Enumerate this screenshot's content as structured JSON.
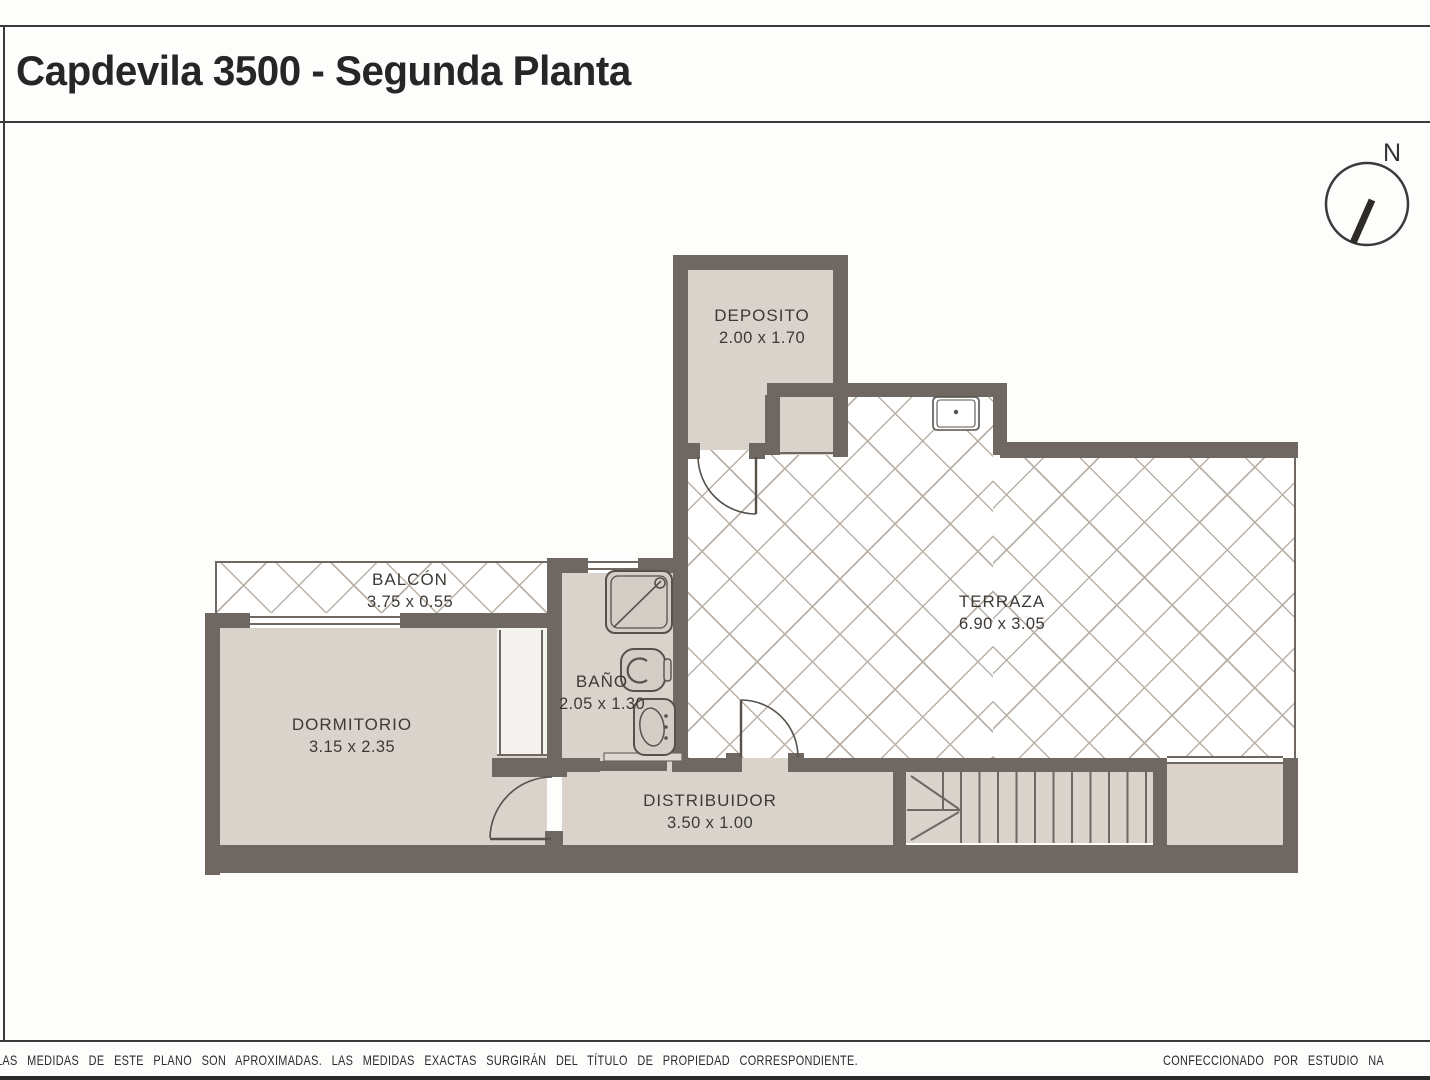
{
  "title": "Capdevila 3500 - Segunda Planta",
  "compass": {
    "label": "N"
  },
  "rooms": {
    "deposito": {
      "name": "DEPOSITO",
      "dims": "2.00 x 1.70"
    },
    "terraza": {
      "name": "TERRAZA",
      "dims": "6.90 x 3.05"
    },
    "balcon": {
      "name": "BALCÓN",
      "dims": "3.75 x 0.55"
    },
    "dormitorio": {
      "name": "DORMITORIO",
      "dims": "3.15 x 2.35"
    },
    "bano": {
      "name": "BAÑO",
      "dims": "2.05 x 1.30"
    },
    "distribuidor": {
      "name": "DISTRIBUIDOR",
      "dims": "3.50 x 1.00"
    }
  },
  "footer": {
    "left": "LAS MEDIDAS  DE ESTE PLANO SON APROXIMADAS. LAS MEDIDAS EXACTAS SURGIRÁN DEL TÍTULO DE PROPIEDAD CORRESPONDIENTE.",
    "right": "CONFECCIONADO POR ESTUDIO NA"
  },
  "colors": {
    "wall": "#6f6862",
    "floor": "#d9d3cc",
    "lattice_line": "#b9b0a6",
    "text": "#3d3a36",
    "title_text": "#262626"
  }
}
